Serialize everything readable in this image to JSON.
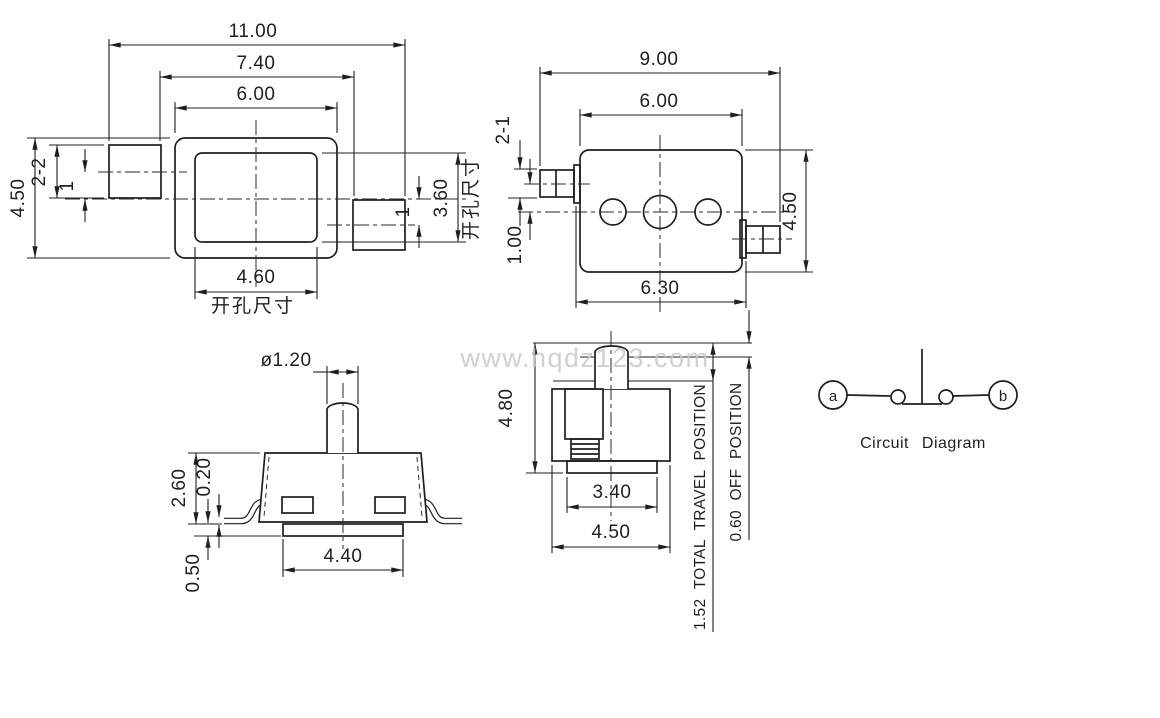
{
  "watermark": "www.hqdz123.com",
  "top_view": {
    "overall_width": "11.00",
    "pad_span": "7.40",
    "body_width": "6.00",
    "cutout_width": "4.60",
    "body_height": "4.50",
    "cutout_height": "3.60",
    "pad_size": "2-2",
    "offset_left": "1",
    "offset_right": "1",
    "cutout_label_right": "开孔尺寸",
    "cutout_label_bottom": "开孔尺寸"
  },
  "pin_view": {
    "overall_width": "9.00",
    "body_width": "6.00",
    "pin_size": "2-1",
    "pin_offset": "1.00",
    "body_height": "4.50",
    "tab_span": "6.30"
  },
  "front_view": {
    "stem_diameter": "ø1.20",
    "body_height": "2.60",
    "lead_thickness": "0.20",
    "base_height": "0.50",
    "base_width": "4.40"
  },
  "side_view": {
    "total_height": "4.80",
    "base_width": "3.40",
    "body_width": "4.50",
    "travel_note": "1.52 TOTAL TRAVEL POSITION",
    "off_note": "0.60 OFF POSITION"
  },
  "circuit": {
    "terminal_a": "a",
    "terminal_b": "b",
    "caption": "Circuit Diagram"
  }
}
